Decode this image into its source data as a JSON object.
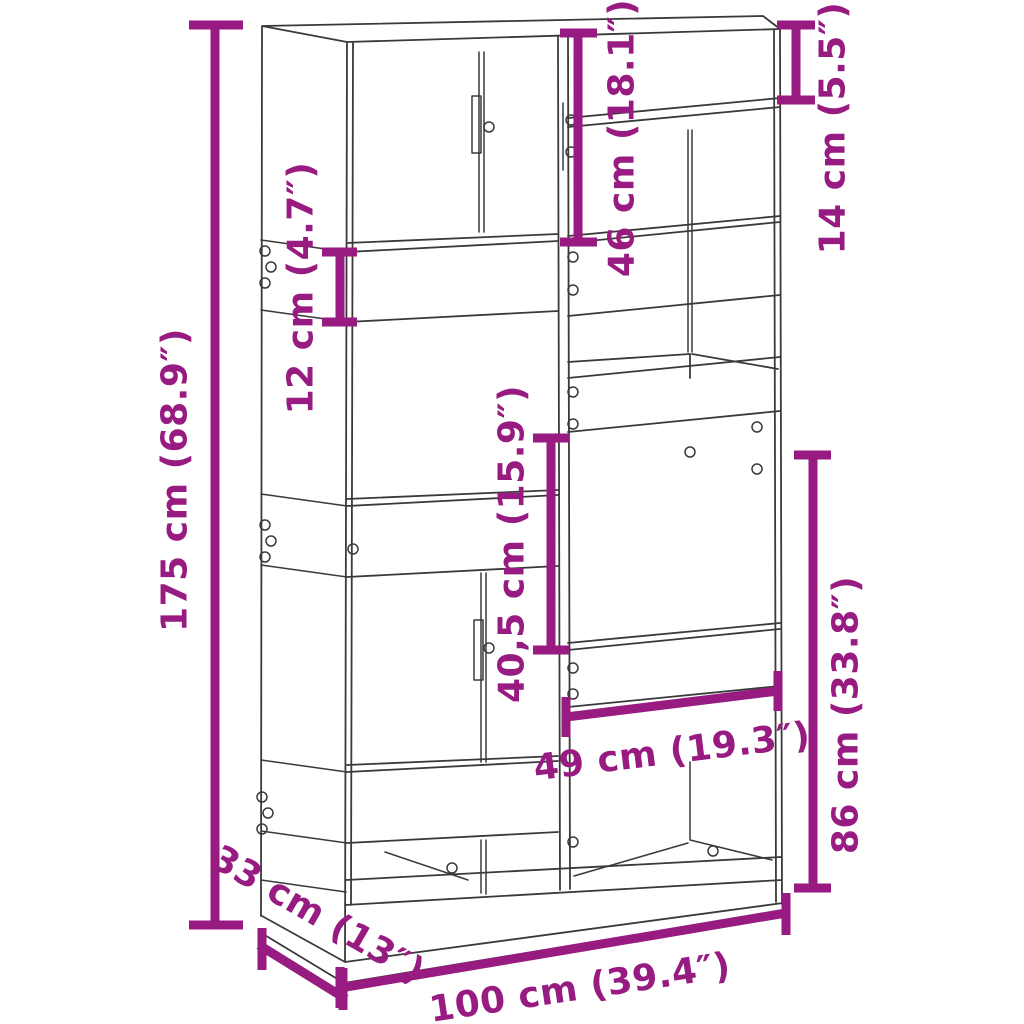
{
  "diagram": {
    "kind": "furniture-dimension-drawing",
    "colors": {
      "dimension_accent": "#971B80",
      "sketch_line": "#3a3a3a",
      "background": "#FFFFFF"
    },
    "dimensions": {
      "total_height": "175 cm (68.9″)",
      "shelf_spacing": "12 cm (4.7″)",
      "upper_right_section": "46 cm (18.1″)",
      "top_right_gap": "14 cm (5.5″)",
      "middle_right_section": "40,5 cm (15.9″)",
      "lower_right_section": "86 cm (33.8″)",
      "inner_width": "49 cm (19.3″)",
      "depth": "33 cm (13″)",
      "total_width": "100 cm (39.4″)"
    }
  }
}
